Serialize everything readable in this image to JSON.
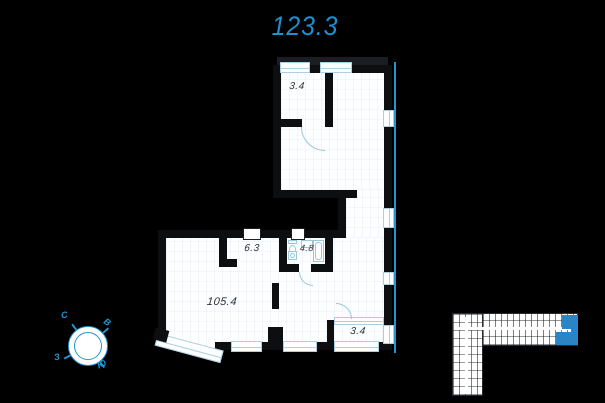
{
  "page": {
    "background_color": "#000000"
  },
  "header": {
    "title": "123.3",
    "title_color": "#1e8fd0"
  },
  "floor_plan": {
    "rooms": [
      {
        "label": "3.4"
      },
      {
        "label": "6.3"
      },
      {
        "label": "4.8"
      },
      {
        "label": "105.4"
      },
      {
        "label": "3.4"
      }
    ],
    "colors": {
      "wall": "#0c0e10",
      "floor": "#fdfeff",
      "glazing": "#a9cfe3",
      "accent_line": "#2196d3",
      "label": "#2e3237"
    }
  },
  "compass": {
    "north": "С",
    "east": "В",
    "south": "Ю",
    "west": "З",
    "color": "#2196d3"
  },
  "minimap": {
    "building_color": "#ffffff",
    "highlight_color": "#2b84c4"
  }
}
